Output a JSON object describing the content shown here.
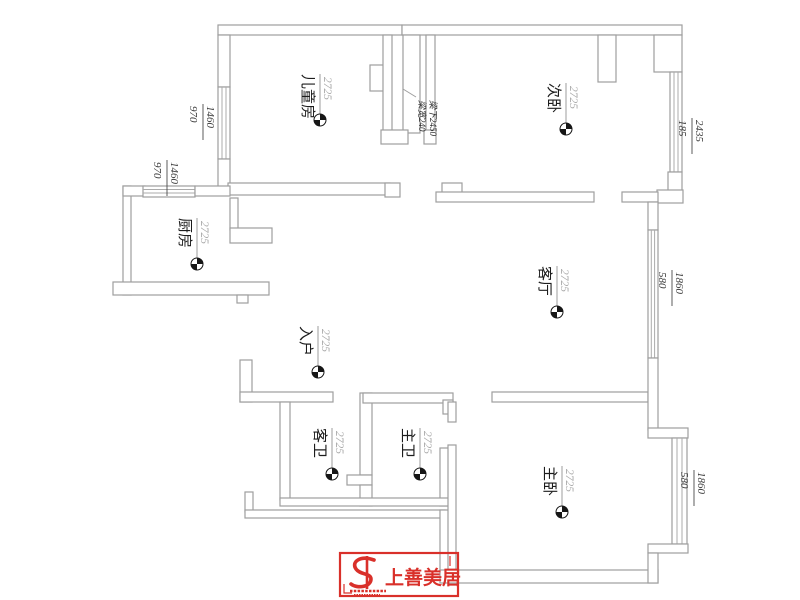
{
  "plan": {
    "elevation": "2725",
    "rooms": [
      {
        "id": "children-room",
        "name": "儿童房"
      },
      {
        "id": "secondary-bedroom",
        "name": "次卧"
      },
      {
        "id": "kitchen",
        "name": "厨房"
      },
      {
        "id": "living-room",
        "name": "客厅"
      },
      {
        "id": "entry",
        "name": "入户"
      },
      {
        "id": "guest-bathroom",
        "name": "客卫"
      },
      {
        "id": "master-bathroom",
        "name": "主卫"
      },
      {
        "id": "master-bedroom",
        "name": "主卧"
      }
    ],
    "beam_note": {
      "line1": "梁宽240",
      "line2": "梁下2450"
    },
    "dimensions": [
      {
        "id": "children-left-window",
        "top": "1460",
        "bottom": "970"
      },
      {
        "id": "kitchen-top-window",
        "top": "1460",
        "bottom": "970"
      },
      {
        "id": "secondary-right-window",
        "top": "2435",
        "bottom": "185"
      },
      {
        "id": "living-right-window",
        "top": "1860",
        "bottom": "580"
      },
      {
        "id": "master-bay-window",
        "top": "1860",
        "bottom": "580"
      }
    ],
    "logo": {
      "text": "上善美居",
      "color": "#d9302a"
    },
    "colors": {
      "wall": "#9e9e9e",
      "label_value": "#a8a8a8",
      "room_text": "#1c1c1c",
      "logo_red": "#d9302a"
    }
  }
}
